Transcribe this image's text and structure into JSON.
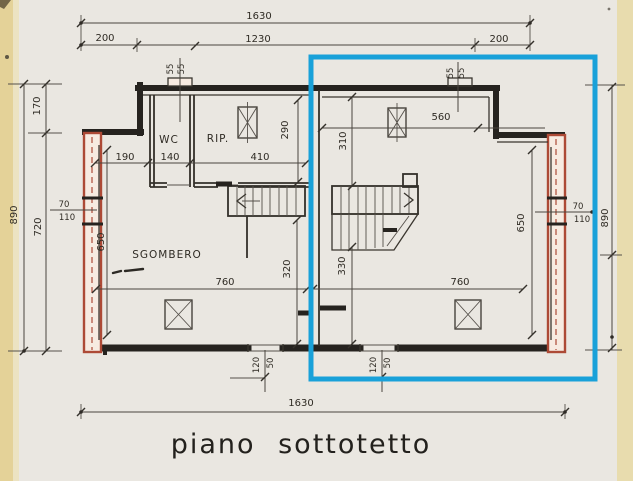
{
  "caption": "piano sottotetto",
  "rooms": {
    "wc": "WC",
    "rip": "RIP.",
    "sgombero": "SGOMBERO"
  },
  "colors": {
    "paper": "#eae7e1",
    "scan_edge_left": "#e4d298",
    "scan_edge_right": "#e8dcae",
    "ink": "#2e2b26",
    "wall_highlight_red": "#ad4a36",
    "selection_blue": "#19a1d9"
  },
  "dims": {
    "top_total": "1630",
    "top_left": "200",
    "top_mid": "1230",
    "top_right": "200",
    "bottom_total": "1630",
    "left_total": "890",
    "left_upper": "170",
    "left_lower": "720",
    "left_wall_a": "70",
    "left_wall_b": "110",
    "left_inner": "650",
    "right_total": "890",
    "right_wall_a": "70",
    "right_wall_b": "110",
    "right_inner": "650",
    "chimney_left_a": "55",
    "chimney_left_b": "55",
    "chimney_right_a": "55",
    "chimney_right_b": "55",
    "gap_left": "190",
    "wc_width": "140",
    "rip_width": "410",
    "rip_height": "290",
    "tr_width": "560",
    "tr_height": "310",
    "stair_left_width": "320",
    "stair_right_width": "330",
    "bl_width": "760",
    "br_width": "760",
    "opening_left_w": "120",
    "opening_left_jamb": "50",
    "opening_right_w": "120",
    "opening_right_jamb": "50"
  }
}
